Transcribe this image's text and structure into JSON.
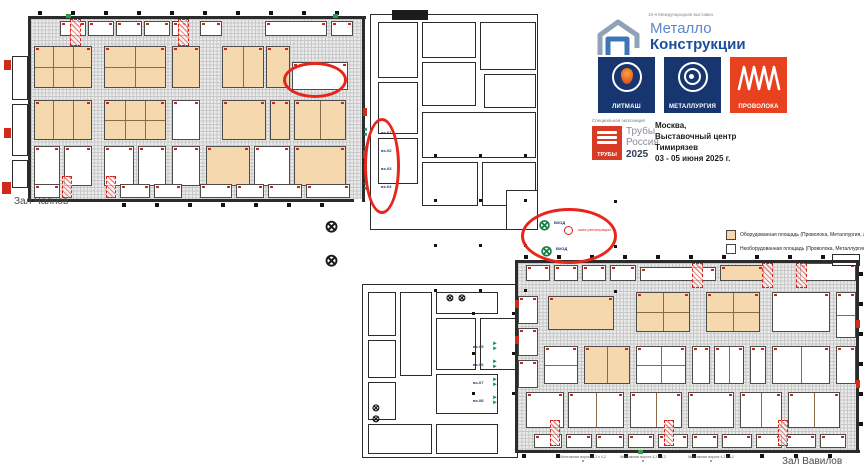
{
  "branding": {
    "edition_note": "10-я Международная выставка",
    "brand_line1": "Металло",
    "brand_line2": "Конструкции",
    "tiles": [
      {
        "label": "ЛИТМАШ",
        "bg": "#17356e",
        "icon": "ladle-icon"
      },
      {
        "label": "МЕТАЛЛУРГИЯ",
        "bg": "#17356e",
        "icon": "coil-icon"
      },
      {
        "label": "ПРОВОЛОКА",
        "bg": "#e8411f",
        "icon": "wire-icon"
      }
    ],
    "special_expo_note": "Специальная экспозиция",
    "truby": {
      "box_label": "ТРУБЫ",
      "line1": "Трубы",
      "line2": "Россия",
      "year": "2025"
    },
    "venue_lines": [
      "Москва,",
      "Выставочный центр",
      "Тимирязев",
      "03 - 05 июня 2025 г."
    ]
  },
  "halls": {
    "hall1_label": "Зал Чаянов",
    "hall2_label": "Зал Вавилов"
  },
  "legend": {
    "items": [
      {
        "swatch": "#f6d8ae",
        "label": "Оборудованная площадь (Проволока, Металлургия, Литмаш)"
      },
      {
        "swatch": "#ffffff",
        "label": "Необорудованная площадь (Проволока, Металлургия, Литмаш)"
      }
    ]
  },
  "entrances": {
    "left_labels": [
      "вх-01",
      "вх-02",
      "вх-03",
      "вх-04"
    ],
    "right_labels": [
      "вх-05",
      "вх-06",
      "вх-07",
      "вх-08"
    ],
    "gate_labels": [
      "ВХОД",
      "ВХОД"
    ],
    "registration_note": "зона регистрации"
  },
  "notes": [
    "Монтажные ворота 4,2 х 4,2 м",
    "Монтажные ворота 4,2 х 4,2 м",
    "Монтажные ворота 4,2 х 4,2 м"
  ],
  "colors": {
    "tan": "#f6d8ae",
    "red": "#e8251a",
    "teal": "#0d8f63",
    "navy": "#17356e",
    "orange": "#e8411f"
  },
  "map": {
    "floors": [
      [
        31,
        19,
        332,
        180
      ],
      [
        518,
        263,
        338,
        187
      ]
    ],
    "booths": [
      [
        60,
        21,
        26,
        15,
        "w",
        0,
        0
      ],
      [
        88,
        21,
        26,
        15,
        "w",
        0,
        0
      ],
      [
        116,
        21,
        26,
        15,
        "w",
        0,
        0
      ],
      [
        144,
        21,
        26,
        15,
        "w",
        0,
        0
      ],
      [
        172,
        21,
        16,
        15,
        "w",
        0,
        0
      ],
      [
        200,
        21,
        22,
        15,
        "w",
        0,
        0
      ],
      [
        265,
        21,
        62,
        15,
        "w",
        0,
        0
      ],
      [
        331,
        21,
        22,
        15,
        "w",
        0,
        0
      ],
      [
        34,
        46,
        58,
        42,
        "t",
        3,
        2
      ],
      [
        104,
        46,
        62,
        42,
        "t",
        2,
        2
      ],
      [
        172,
        46,
        28,
        42,
        "t",
        0,
        0
      ],
      [
        222,
        46,
        42,
        42,
        "t",
        2,
        0
      ],
      [
        266,
        46,
        24,
        42,
        "t",
        0,
        0
      ],
      [
        292,
        62,
        56,
        28,
        "w",
        0,
        0
      ],
      [
        34,
        100,
        58,
        40,
        "t",
        3,
        0
      ],
      [
        104,
        100,
        62,
        40,
        "t",
        3,
        2
      ],
      [
        172,
        100,
        28,
        40,
        "w",
        0,
        0
      ],
      [
        222,
        100,
        44,
        40,
        "t",
        0,
        0
      ],
      [
        270,
        100,
        20,
        40,
        "t",
        0,
        0
      ],
      [
        294,
        100,
        52,
        40,
        "t",
        2,
        0
      ],
      [
        34,
        146,
        26,
        40,
        "w",
        0,
        0
      ],
      [
        64,
        146,
        28,
        40,
        "w",
        0,
        0
      ],
      [
        104,
        146,
        30,
        40,
        "w",
        0,
        0
      ],
      [
        138,
        146,
        28,
        40,
        "w",
        0,
        0
      ],
      [
        172,
        146,
        28,
        40,
        "w",
        0,
        0
      ],
      [
        206,
        146,
        44,
        40,
        "t",
        0,
        0
      ],
      [
        254,
        146,
        36,
        40,
        "w",
        0,
        0
      ],
      [
        294,
        146,
        52,
        40,
        "t",
        0,
        0
      ],
      [
        34,
        184,
        26,
        14,
        "w",
        0,
        0
      ],
      [
        120,
        184,
        30,
        14,
        "w",
        0,
        0
      ],
      [
        154,
        184,
        28,
        14,
        "w",
        0,
        0
      ],
      [
        200,
        184,
        32,
        14,
        "w",
        0,
        0
      ],
      [
        236,
        184,
        28,
        14,
        "w",
        0,
        0
      ],
      [
        268,
        184,
        34,
        14,
        "w",
        0,
        0
      ],
      [
        306,
        184,
        44,
        14,
        "w",
        0,
        0
      ],
      [
        526,
        265,
        24,
        16,
        "w",
        0,
        0
      ],
      [
        554,
        265,
        24,
        16,
        "w",
        0,
        0
      ],
      [
        582,
        265,
        24,
        16,
        "w",
        0,
        0
      ],
      [
        610,
        265,
        26,
        16,
        "w",
        0,
        0
      ],
      [
        640,
        267,
        76,
        14,
        "w",
        0,
        0
      ],
      [
        720,
        265,
        44,
        16,
        "t",
        0,
        0
      ],
      [
        800,
        263,
        56,
        18,
        "w",
        0,
        0
      ],
      [
        518,
        296,
        20,
        28,
        "w",
        0,
        0
      ],
      [
        518,
        328,
        20,
        28,
        "w",
        0,
        0
      ],
      [
        518,
        360,
        20,
        28,
        "w",
        0,
        0
      ],
      [
        548,
        296,
        66,
        34,
        "t",
        0,
        0
      ],
      [
        636,
        292,
        54,
        40,
        "t",
        2,
        2
      ],
      [
        706,
        292,
        54,
        40,
        "t",
        2,
        2
      ],
      [
        772,
        292,
        58,
        40,
        "w",
        0,
        0
      ],
      [
        836,
        292,
        20,
        46,
        "w",
        0,
        2
      ],
      [
        544,
        346,
        34,
        38,
        "w",
        0,
        2
      ],
      [
        584,
        346,
        46,
        38,
        "t",
        2,
        0
      ],
      [
        636,
        346,
        50,
        38,
        "w",
        2,
        2
      ],
      [
        692,
        346,
        18,
        38,
        "w",
        0,
        0
      ],
      [
        714,
        346,
        30,
        38,
        "w",
        2,
        0
      ],
      [
        750,
        346,
        16,
        38,
        "w",
        0,
        0
      ],
      [
        772,
        346,
        58,
        38,
        "w",
        2,
        0
      ],
      [
        836,
        346,
        20,
        38,
        "w",
        0,
        0
      ],
      [
        526,
        392,
        38,
        36,
        "w",
        0,
        0
      ],
      [
        568,
        392,
        56,
        36,
        "w",
        2,
        0
      ],
      [
        630,
        392,
        52,
        36,
        "w",
        2,
        0
      ],
      [
        688,
        392,
        46,
        36,
        "w",
        0,
        0
      ],
      [
        740,
        392,
        42,
        36,
        "w",
        2,
        0
      ],
      [
        788,
        392,
        52,
        36,
        "w",
        2,
        0
      ],
      [
        534,
        434,
        28,
        14,
        "w",
        0,
        0
      ],
      [
        566,
        434,
        26,
        14,
        "w",
        0,
        0
      ],
      [
        596,
        434,
        28,
        14,
        "w",
        0,
        0
      ],
      [
        628,
        434,
        26,
        14,
        "w",
        0,
        0
      ],
      [
        658,
        434,
        30,
        14,
        "w",
        0,
        0
      ],
      [
        692,
        434,
        26,
        14,
        "w",
        0,
        0
      ],
      [
        722,
        434,
        30,
        14,
        "w",
        0,
        0
      ],
      [
        756,
        434,
        26,
        14,
        "w",
        0,
        0
      ],
      [
        786,
        434,
        30,
        14,
        "w",
        0,
        0
      ],
      [
        820,
        434,
        26,
        14,
        "w",
        0,
        0
      ]
    ],
    "strips": [
      [
        70,
        19,
        11,
        27
      ],
      [
        178,
        19,
        11,
        27
      ],
      [
        62,
        176,
        10,
        22
      ],
      [
        106,
        176,
        10,
        22
      ],
      [
        692,
        263,
        11,
        25
      ],
      [
        762,
        263,
        11,
        25
      ],
      [
        796,
        263,
        11,
        25
      ],
      [
        550,
        420,
        10,
        26
      ],
      [
        664,
        420,
        10,
        26
      ],
      [
        778,
        420,
        10,
        26
      ]
    ],
    "rooms": [
      [
        12,
        56,
        16,
        44
      ],
      [
        12,
        104,
        16,
        52
      ],
      [
        12,
        160,
        16,
        28
      ],
      [
        370,
        14,
        168,
        216
      ],
      [
        378,
        22,
        40,
        56
      ],
      [
        378,
        82,
        40,
        52
      ],
      [
        378,
        138,
        40,
        46
      ],
      [
        422,
        22,
        54,
        36
      ],
      [
        480,
        22,
        56,
        48
      ],
      [
        422,
        62,
        54,
        44
      ],
      [
        484,
        74,
        52,
        34
      ],
      [
        422,
        112,
        114,
        46
      ],
      [
        422,
        162,
        56,
        44
      ],
      [
        482,
        162,
        54,
        44
      ],
      [
        506,
        190,
        32,
        40
      ],
      [
        362,
        284,
        156,
        174
      ],
      [
        368,
        292,
        28,
        44
      ],
      [
        368,
        340,
        28,
        38
      ],
      [
        368,
        382,
        28,
        38
      ],
      [
        400,
        292,
        32,
        84
      ],
      [
        436,
        292,
        62,
        22
      ],
      [
        436,
        318,
        40,
        52
      ],
      [
        480,
        318,
        38,
        52
      ],
      [
        436,
        374,
        62,
        40
      ],
      [
        368,
        424,
        64,
        30
      ],
      [
        436,
        424,
        62,
        30
      ],
      [
        832,
        254,
        28,
        12
      ]
    ],
    "blackrects": [
      [
        392,
        10,
        36,
        10
      ]
    ],
    "walls": [
      [
        28,
        16,
        338,
        3
      ],
      [
        28,
        16,
        3,
        186
      ],
      [
        28,
        199,
        326,
        3
      ],
      [
        362,
        16,
        3,
        186
      ],
      [
        515,
        260,
        345,
        3
      ],
      [
        515,
        260,
        3,
        193
      ],
      [
        515,
        450,
        345,
        3
      ],
      [
        856,
        262,
        3,
        191
      ]
    ],
    "dotgrids": [
      [
        434,
        154,
        45,
        45,
        3,
        4,
        3
      ],
      [
        472,
        312,
        40,
        40,
        2,
        3,
        3
      ],
      [
        614,
        200,
        45,
        45,
        1,
        3,
        3
      ],
      [
        38,
        11,
        33,
        1,
        10,
        1,
        4
      ],
      [
        122,
        203,
        33,
        1,
        7,
        1,
        4
      ],
      [
        524,
        255,
        33,
        1,
        10,
        1,
        4
      ],
      [
        522,
        454,
        34,
        1,
        10,
        1,
        4
      ],
      [
        859,
        272,
        1,
        30,
        1,
        6,
        4
      ]
    ],
    "gates": [
      [
        322,
        218,
        17,
        "k"
      ],
      [
        322,
        252,
        17,
        "k"
      ],
      [
        536,
        218,
        15,
        "g"
      ],
      [
        538,
        244,
        15,
        "g"
      ],
      [
        444,
        294,
        10,
        "k"
      ],
      [
        456,
        294,
        10,
        "k"
      ],
      [
        370,
        404,
        10,
        "k"
      ],
      [
        370,
        415,
        10,
        "k"
      ]
    ],
    "arrow_groups": [
      {
        "dir": "left",
        "x": 362,
        "ys": [
          128,
          146,
          164,
          182
        ],
        "label_x": 381,
        "labels_key": "left_labels"
      },
      {
        "dir": "right",
        "x": 492,
        "ys": [
          342,
          360,
          378,
          396
        ],
        "label_x": 473,
        "labels_key": "right_labels"
      }
    ],
    "gate_label_pos": [
      [
        554,
        220
      ],
      [
        556,
        246
      ]
    ],
    "reg_icon": {
      "x": 564,
      "y": 226,
      "r": 9,
      "tx": 578,
      "ty": 228
    },
    "ellipses": [
      [
        283,
        62,
        64,
        36
      ],
      [
        364,
        118,
        36,
        96
      ],
      [
        521,
        208,
        96,
        56
      ]
    ],
    "greenmarks": [
      [
        66,
        14,
        5,
        4
      ],
      [
        333,
        14,
        5,
        4
      ],
      [
        638,
        450,
        5,
        4
      ]
    ],
    "redmarks": [
      [
        4,
        60,
        7,
        10
      ],
      [
        4,
        128,
        7,
        10
      ],
      [
        2,
        182,
        9,
        12
      ],
      [
        363,
        108,
        4,
        8
      ],
      [
        363,
        150,
        4,
        8
      ],
      [
        515,
        300,
        4,
        8
      ],
      [
        515,
        336,
        4,
        8
      ],
      [
        856,
        320,
        4,
        8
      ],
      [
        856,
        380,
        4,
        8
      ]
    ],
    "note_pos": [
      [
        560,
        455
      ],
      [
        620,
        455
      ],
      [
        688,
        455
      ]
    ],
    "hall_label_pos": {
      "hall1": [
        14,
        196
      ],
      "hall2": [
        782,
        456
      ]
    }
  }
}
